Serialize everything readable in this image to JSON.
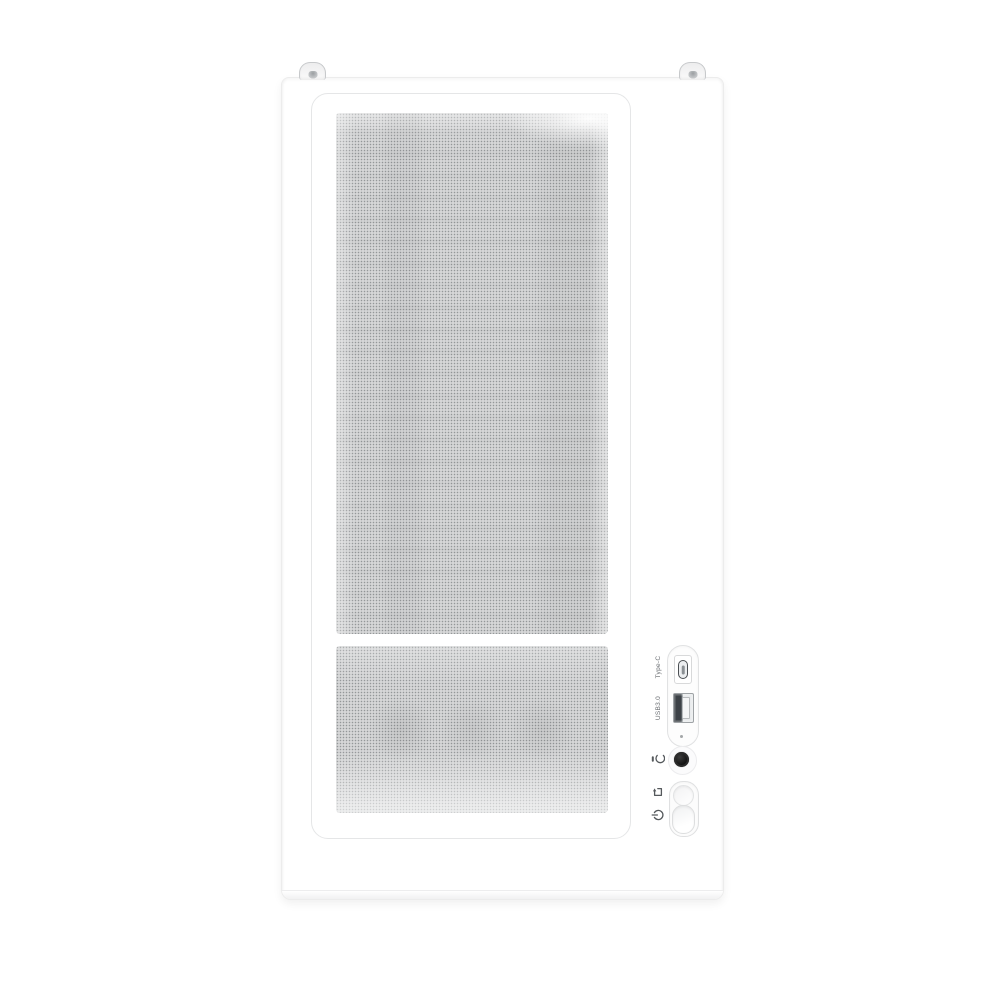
{
  "scene": {
    "description": "front view of a white mesh-front PC tower case on white background",
    "background_color": "#ffffff"
  },
  "colors": {
    "case_body": "#ffffff",
    "panel_border": "#e5e6e7",
    "mesh_dot": "#34393d",
    "audio_jack": "#101010",
    "usb_port_dark": "#3d4247",
    "label_text": "#686c70"
  },
  "io_panel": {
    "typec_label": "Type-C",
    "usb_label": "USB3.0",
    "icons": {
      "audio": "headphone-mic-icon",
      "reset": "reset-icon",
      "power": "power-icon"
    },
    "has_led_indicator": true
  }
}
